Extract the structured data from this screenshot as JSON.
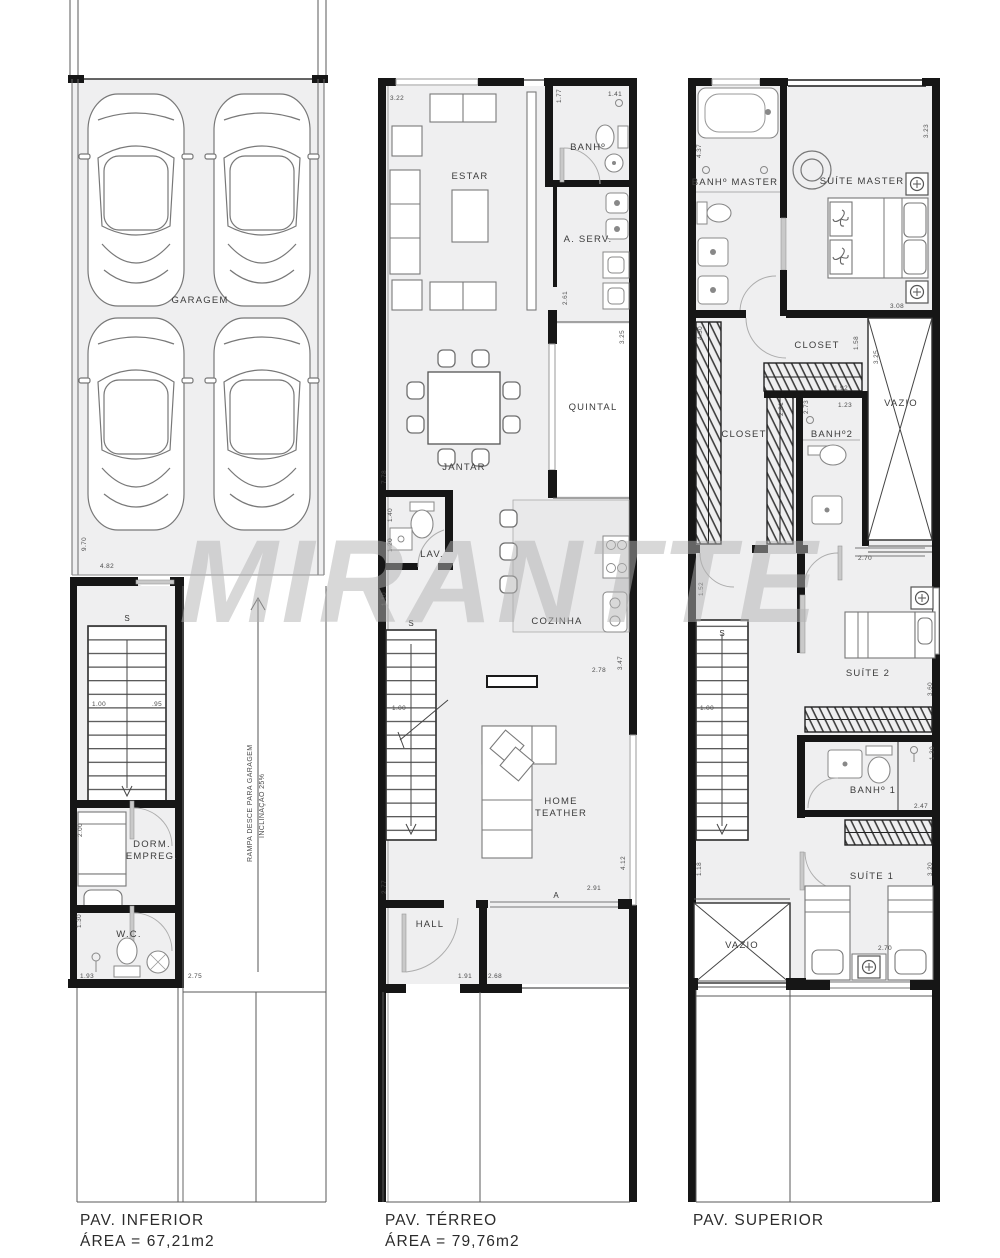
{
  "watermark": "MIRANTTE",
  "f1": {
    "title": "PAV. INFERIOR",
    "area": "ÁREA = 67,21m2",
    "garagem": "GARAGEM",
    "dorm1": "DORM.",
    "dorm2": "EMPREG.",
    "wc": "W.C.",
    "ramp1": "RAMPA DESCE PARA GARAGEM",
    "ramp2": "INCLINAÇÃO 25%",
    "s": "S",
    "d": {
      "a": "9.70",
      "b": "4.82",
      "c": "1.00",
      "d": ".95",
      "e": "2.00",
      "f": "1.30",
      "g": "1.93",
      "h": "2.75"
    }
  },
  "f2": {
    "title": "PAV. TÉRREO",
    "area": "ÁREA = 79,76m2",
    "estar": "ESTAR",
    "banh": "BANHº",
    "aserv": "A. SERV.",
    "quintal": "QUINTAL",
    "jantar": "JANTAR",
    "lav": "LAV.",
    "cozinha": "COZINHA",
    "home1": "HOME",
    "home2": "TEATHER",
    "hall": "HALL",
    "s": "S",
    "amark": "A",
    "d": {
      "a": "3.22",
      "b": "1.77",
      "c": "1.41",
      "d": "2.61",
      "e": "3.25",
      "f": "7.78",
      "g": "1.40",
      "h": "1.20",
      "i": "1.10",
      "j": "1.00",
      "k": "3.47",
      "l": "2.78",
      "m": "2.91",
      "n": "4.12",
      "o": "2.77",
      "p": "1.91",
      "q": "2.68"
    }
  },
  "f3": {
    "title": "PAV. SUPERIOR",
    "banhmaster": "BANHº MASTER",
    "suitemaster": "SUÍTE MASTER",
    "closet": "CLOSET",
    "closet2": "CLOSET",
    "banh2": "BANHº2",
    "vazio": "VAZIO",
    "suite2": "SUÍTE 2",
    "banh1": "BANHº 1",
    "suite1": "SUÍTE 1",
    "vazio2": "VAZIO",
    "s": "S",
    "d": {
      "a": "4.37",
      "b": "3.23",
      "c": "3.08",
      "d": "4.30",
      "e": "1.58",
      "f": "1.92",
      "g": "2.81",
      "h": "2.73",
      "i": "1.23",
      "j": "3.25",
      "k": "2.70",
      "l": "1.52",
      "m": "1.00",
      "n": "3.60",
      "o": "1.30",
      "p": "2.47",
      "q": "1.18",
      "r": "3.20",
      "s2": "2.70"
    }
  }
}
